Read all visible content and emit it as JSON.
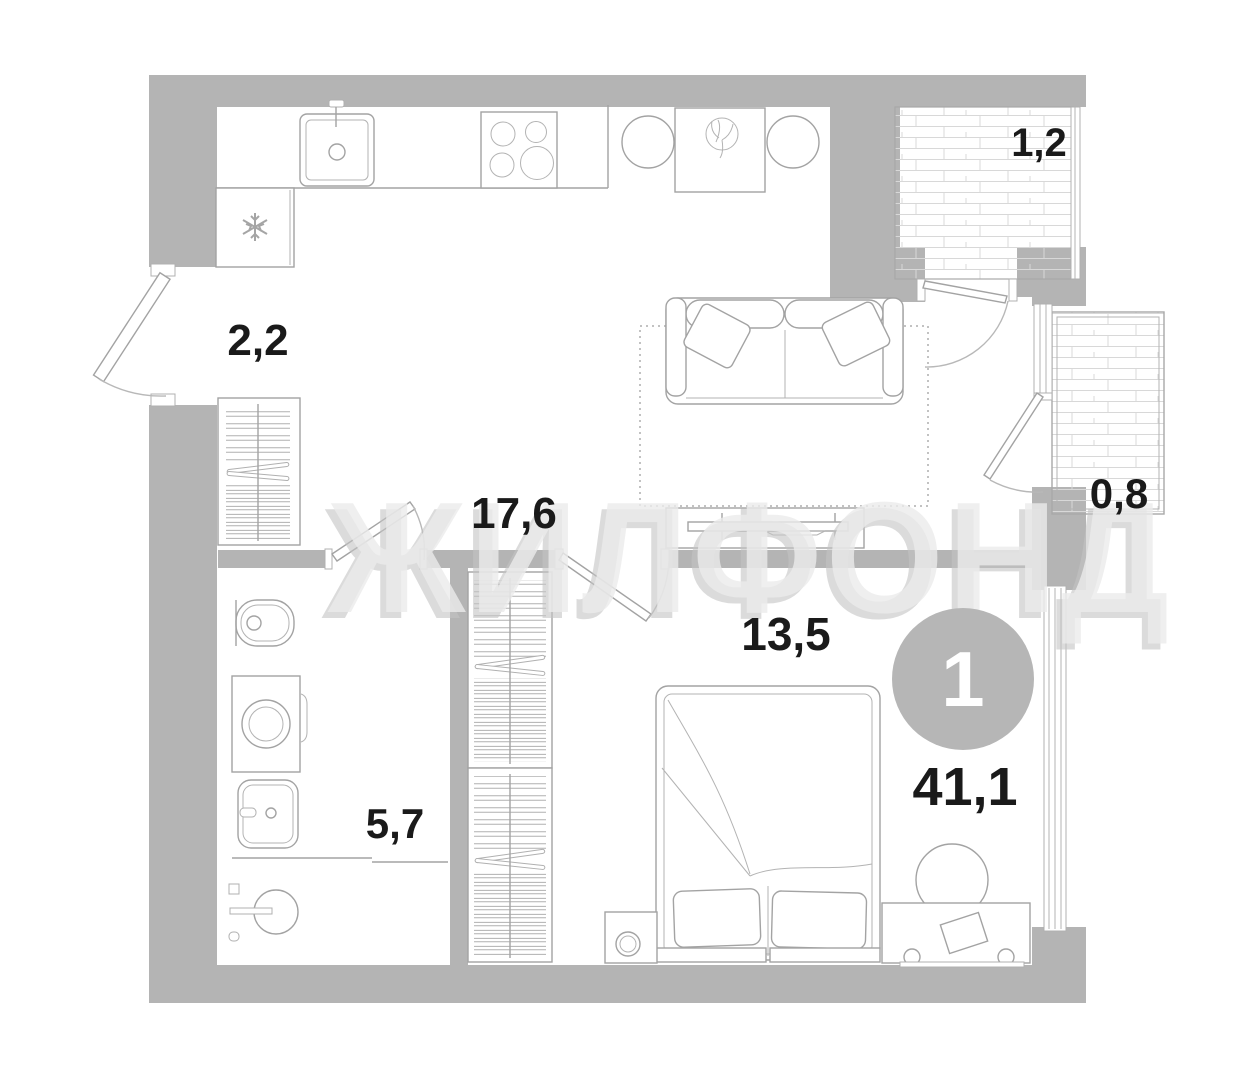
{
  "plan": {
    "watermark": "ЖИЛФОНД",
    "badge": {
      "rooms_count": "1",
      "total_area": "41,1"
    },
    "rooms": {
      "hallway": {
        "name": "hallway",
        "area": "2,2"
      },
      "kitchen_living": {
        "name": "kitchen-living-room",
        "area": "17,6"
      },
      "bedroom": {
        "name": "bedroom",
        "area": "13,5"
      },
      "bathroom": {
        "name": "bathroom",
        "area": "5,7"
      },
      "balcony_top": {
        "name": "balcony",
        "area": "1,2"
      },
      "balcony_right": {
        "name": "loggia",
        "area": "0,8"
      }
    },
    "icons": {
      "fridge": "snowflake-icon",
      "stove": "four-burner-stove-icon",
      "sink": "kitchen-sink-icon",
      "shower": "shower-head-icon"
    },
    "colors": {
      "wall": "#b4b4b4",
      "furniture_line": "#a3a3a3",
      "hatch": "#d8d8d8",
      "label_text": "#1a1a1a",
      "badge_fill": "#b6b6b6",
      "badge_text": "#ffffff",
      "watermark_front": "#ececec",
      "watermark_shadow": "#c4c4c4"
    }
  }
}
